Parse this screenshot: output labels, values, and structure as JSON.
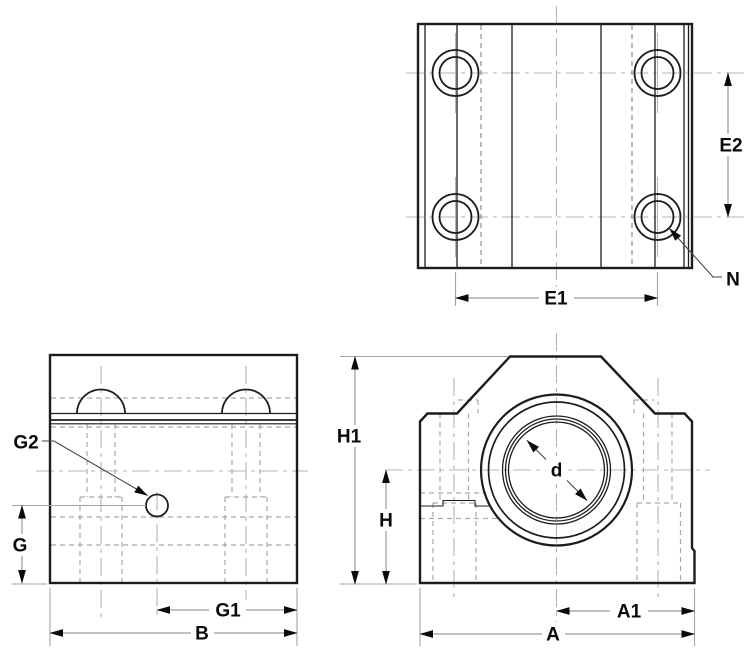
{
  "labels": {
    "e1": "E1",
    "e2": "E2",
    "n": "N",
    "g": "G",
    "g1": "G1",
    "g2": "G2",
    "b": "B",
    "h": "H",
    "h1": "H1",
    "a": "A",
    "a1": "A1",
    "d": "d"
  },
  "colors": {
    "background": "#ffffff",
    "outline": "#1c1c1c",
    "hidden_line": "#a9a9a9",
    "center_line": "#b5b5b5",
    "dimension_line": "#9a9a9a",
    "label_text": "#0a0a0a"
  }
}
